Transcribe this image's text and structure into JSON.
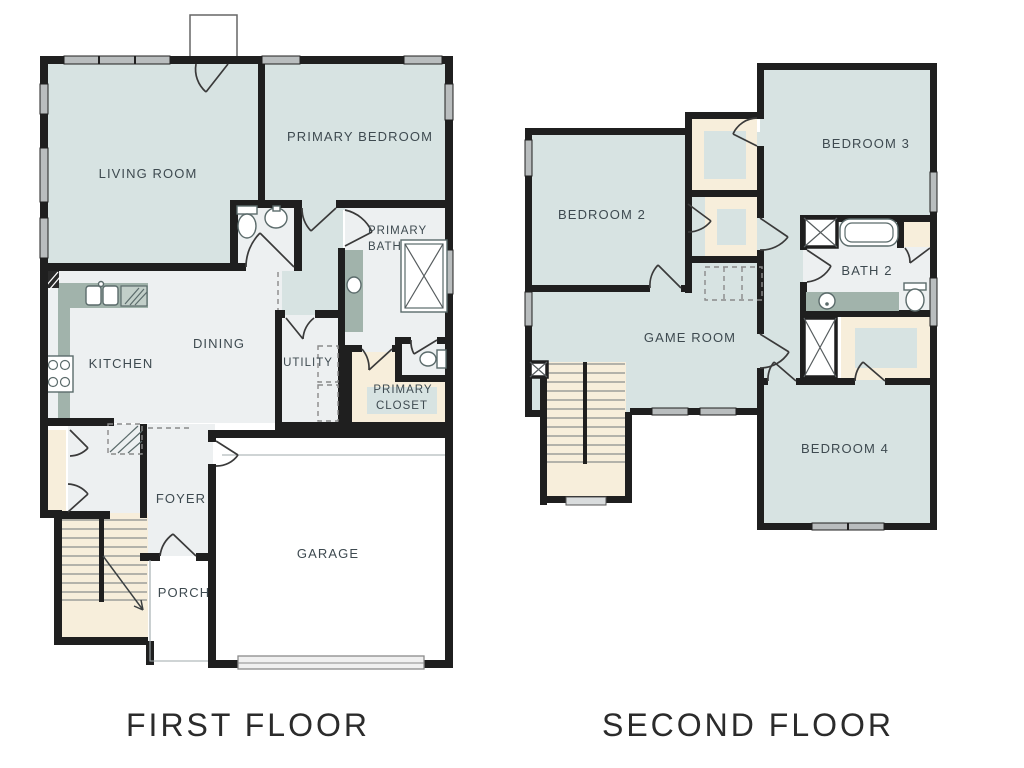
{
  "palette": {
    "wall": "#1f1f1f",
    "room_fill": "#d7e3e2",
    "floor_fill": "#edf0f1",
    "cream": "#f7eedb",
    "counter": "#a1b3ab",
    "window": "#b9bdbe",
    "label": "#3e4a50",
    "title": "#2b2b2b",
    "fixture_stroke": "#5b6b6b",
    "door_stroke": "#3a3a3a",
    "dash": "#8a8a8a"
  },
  "floor1": {
    "title": "FIRST FLOOR",
    "rooms": {
      "living_room": "LIVING ROOM",
      "primary_bedroom": "PRIMARY BEDROOM",
      "primary_bath_line1": "PRIMARY",
      "primary_bath_line2": "BATH",
      "kitchen": "KITCHEN",
      "dining": "DINING",
      "utility": "UTILITY",
      "primary_closet_line1": "PRIMARY",
      "primary_closet_line2": "CLOSET",
      "foyer": "FOYER",
      "porch": "PORCH",
      "garage": "GARAGE"
    }
  },
  "floor2": {
    "title": "SECOND FLOOR",
    "rooms": {
      "bedroom2": "BEDROOM 2",
      "bedroom3": "BEDROOM 3",
      "bath2": "BATH 2",
      "game_room": "GAME ROOM",
      "bedroom4": "BEDROOM 4"
    }
  }
}
